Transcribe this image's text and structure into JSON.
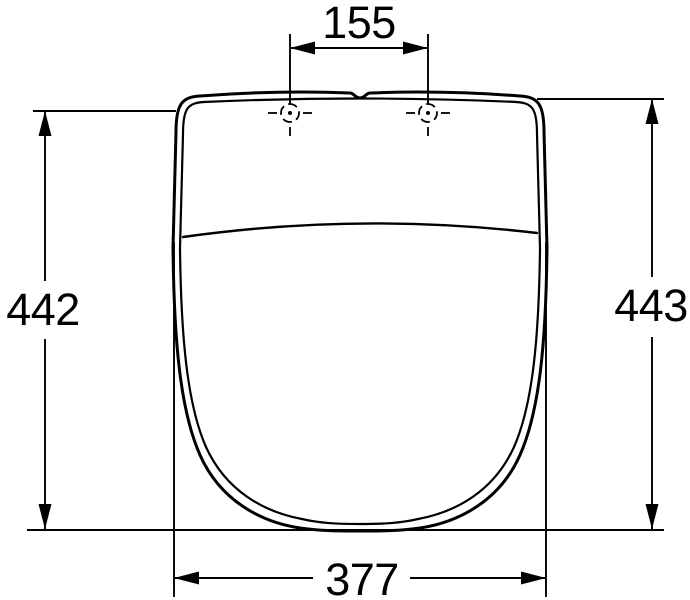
{
  "colors": {
    "ink": "#000000",
    "background": "#ffffff"
  },
  "dimensions": {
    "hinge_hole_spacing": {
      "label": "155"
    },
    "height_left": {
      "label": "442"
    },
    "height_right": {
      "label": "443"
    },
    "width_bottom": {
      "label": "377"
    }
  }
}
